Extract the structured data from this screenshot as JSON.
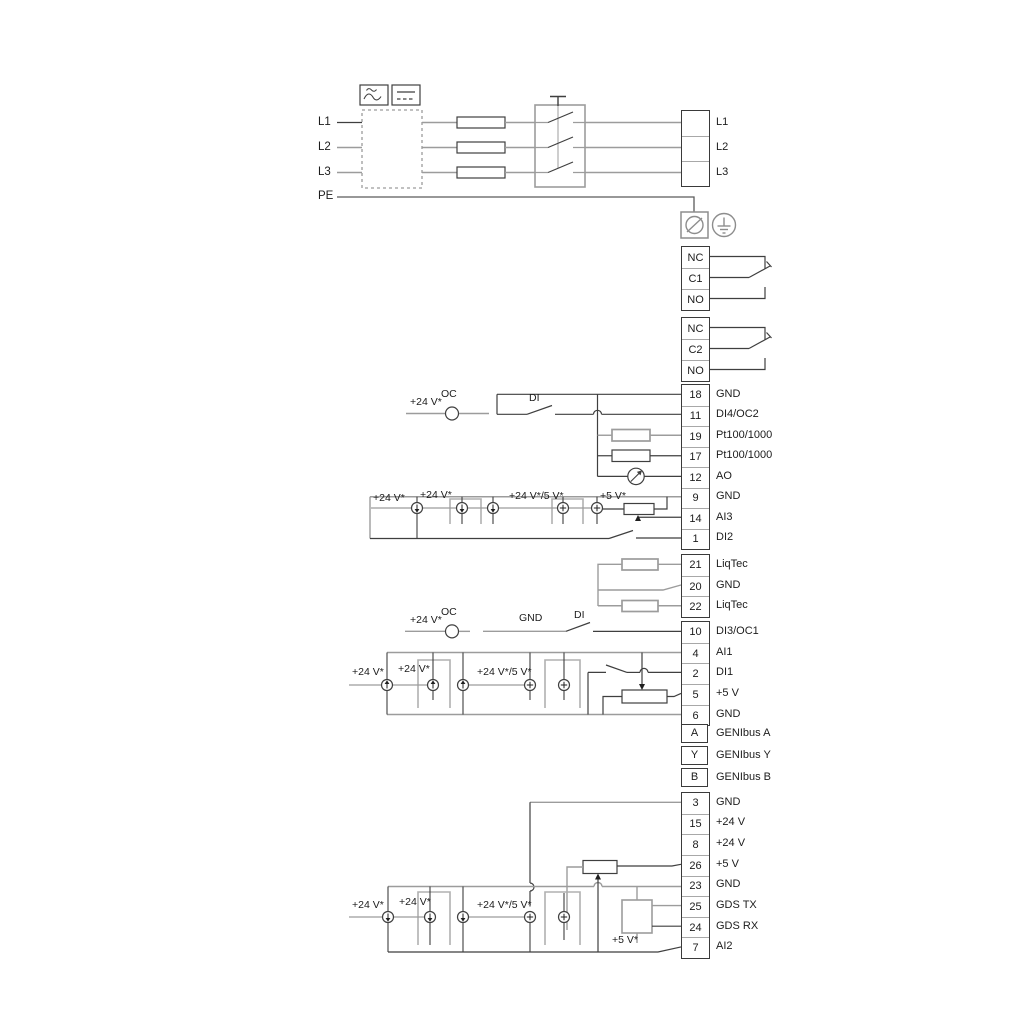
{
  "diagram": {
    "type": "pump-drive-wiring-diagram",
    "colors": {
      "line_gray": "#9c9c9c",
      "line_dark": "#3f3f3f",
      "text": "#1c1c1c"
    },
    "power_input_labels": [
      {
        "text": "L1",
        "x": 318,
        "y": 116
      },
      {
        "text": "L2",
        "x": 318,
        "y": 141
      },
      {
        "text": "L3",
        "x": 318,
        "y": 166
      },
      {
        "text": "PE",
        "x": 318,
        "y": 190
      }
    ],
    "wire_labels": [
      {
        "text": "+24 V*",
        "x": 410,
        "y": 396
      },
      {
        "text": "OC",
        "x": 441,
        "y": 388
      },
      {
        "text": "DI",
        "x": 529,
        "y": 392
      },
      {
        "text": "+24 V*",
        "x": 373,
        "y": 492
      },
      {
        "text": "+24 V*",
        "x": 420,
        "y": 489
      },
      {
        "text": "+24 V*/5 V*",
        "x": 509,
        "y": 490
      },
      {
        "text": "+5 V*",
        "x": 600,
        "y": 490
      },
      {
        "text": "+24 V*",
        "x": 410,
        "y": 614
      },
      {
        "text": "OC",
        "x": 441,
        "y": 606
      },
      {
        "text": "GND",
        "x": 519,
        "y": 612
      },
      {
        "text": "DI",
        "x": 574,
        "y": 609
      },
      {
        "text": "+24 V*",
        "x": 352,
        "y": 666
      },
      {
        "text": "+24 V*",
        "x": 398,
        "y": 663
      },
      {
        "text": "+24 V*/5 V*",
        "x": 477,
        "y": 666
      },
      {
        "text": "+24 V*",
        "x": 352,
        "y": 899
      },
      {
        "text": "+24 V*",
        "x": 399,
        "y": 896
      },
      {
        "text": "+24 V*/5 V*",
        "x": 477,
        "y": 899
      },
      {
        "text": "+5 V*",
        "x": 612,
        "y": 934
      }
    ],
    "terminal_groups": {
      "mains_out": {
        "items": [
          {
            "num": "",
            "label": "L1"
          },
          {
            "num": "",
            "label": "L2"
          },
          {
            "num": "",
            "label": "L3"
          }
        ]
      },
      "relay1": {
        "items": [
          {
            "num": "NC",
            "label": ""
          },
          {
            "num": "C1",
            "label": ""
          },
          {
            "num": "NO",
            "label": ""
          }
        ]
      },
      "relay2": {
        "items": [
          {
            "num": "NC",
            "label": ""
          },
          {
            "num": "C2",
            "label": ""
          },
          {
            "num": "NO",
            "label": ""
          }
        ]
      },
      "io_a": {
        "items": [
          {
            "num": "18",
            "label": "GND"
          },
          {
            "num": "11",
            "label": "DI4/OC2"
          },
          {
            "num": "19",
            "label": "Pt100/1000"
          },
          {
            "num": "17",
            "label": "Pt100/1000"
          },
          {
            "num": "12",
            "label": "AO"
          },
          {
            "num": "9",
            "label": "GND"
          },
          {
            "num": "14",
            "label": "AI3"
          },
          {
            "num": "1",
            "label": "DI2"
          }
        ]
      },
      "liqtec": {
        "items": [
          {
            "num": "21",
            "label": "LiqTec"
          },
          {
            "num": "20",
            "label": "GND"
          },
          {
            "num": "22",
            "label": "LiqTec"
          }
        ]
      },
      "io_b": {
        "items": [
          {
            "num": "10",
            "label": "DI3/OC1"
          },
          {
            "num": "4",
            "label": "AI1"
          },
          {
            "num": "2",
            "label": "DI1"
          },
          {
            "num": "5",
            "label": "+5 V"
          },
          {
            "num": "6",
            "label": "GND"
          }
        ]
      },
      "genibus": {
        "items": [
          {
            "num": "A",
            "label": "GENIbus A"
          },
          {
            "num": "Y",
            "label": "GENIbus Y"
          },
          {
            "num": "B",
            "label": "GENIbus B"
          }
        ]
      },
      "io_c": {
        "items": [
          {
            "num": "3",
            "label": "GND"
          },
          {
            "num": "15",
            "label": "+24 V"
          },
          {
            "num": "8",
            "label": "+24 V"
          },
          {
            "num": "26",
            "label": "+5 V"
          },
          {
            "num": "23",
            "label": "GND"
          },
          {
            "num": "25",
            "label": "GDS TX"
          },
          {
            "num": "24",
            "label": "GDS RX"
          },
          {
            "num": "7",
            "label": "AI2"
          }
        ]
      }
    }
  }
}
